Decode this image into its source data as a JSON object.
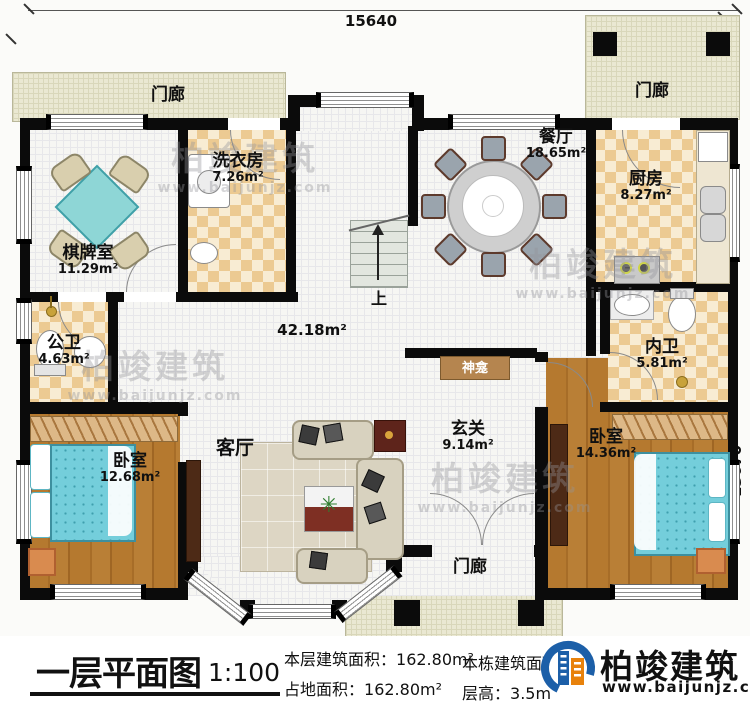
{
  "dimensions": {
    "top": "15640",
    "right": "13670"
  },
  "rooms": {
    "porch_top_left": {
      "label": "门廊"
    },
    "porch_top_right": {
      "label": "门廊"
    },
    "porch_bottom": {
      "label": "门廊"
    },
    "chess": {
      "label": "棋牌室",
      "area": "11.29m²"
    },
    "laundry": {
      "label": "洗衣房",
      "area": "7.26m²"
    },
    "dining": {
      "label": "餐厅",
      "area": "18.65m²"
    },
    "kitchen": {
      "label": "厨房",
      "area": "8.27m²"
    },
    "public_bath": {
      "label": "公卫",
      "area": "4.63m²"
    },
    "inner_bath": {
      "label": "内卫",
      "area": "5.81m²"
    },
    "hall": {
      "area": "42.18m²"
    },
    "shrine": {
      "label": "神龛"
    },
    "entry": {
      "label": "玄关",
      "area": "9.14m²"
    },
    "living": {
      "label": "客厅"
    },
    "bedroom_left": {
      "label": "卧室",
      "area": "12.68m²"
    },
    "bedroom_right": {
      "label": "卧室",
      "area": "14.36m²"
    },
    "stairs": {
      "label": "上"
    }
  },
  "footer": {
    "title": "一层平面图",
    "scale": "1:100",
    "stats": [
      {
        "label": "本层建筑面积：",
        "value": "162.80m²"
      },
      {
        "label": "占地面积：",
        "value": "162.80m²"
      },
      {
        "label": "本栋建筑面积：",
        "value": ""
      },
      {
        "label": "层高：",
        "value": "3.5m"
      }
    ],
    "brand": {
      "name": "柏竣建筑",
      "url": "www.baijunjz.com"
    }
  },
  "watermark": {
    "name": "柏竣建筑",
    "url": "www.baijunjz.com"
  },
  "colors": {
    "wall": "#0b0b0b",
    "checker": "#ecca92",
    "wood": "#b5792f",
    "bed_teal": "#74cedb",
    "porch": "#eae8d2",
    "brand_blue": "#1c5fa8",
    "brand_orange": "#e8820c"
  }
}
